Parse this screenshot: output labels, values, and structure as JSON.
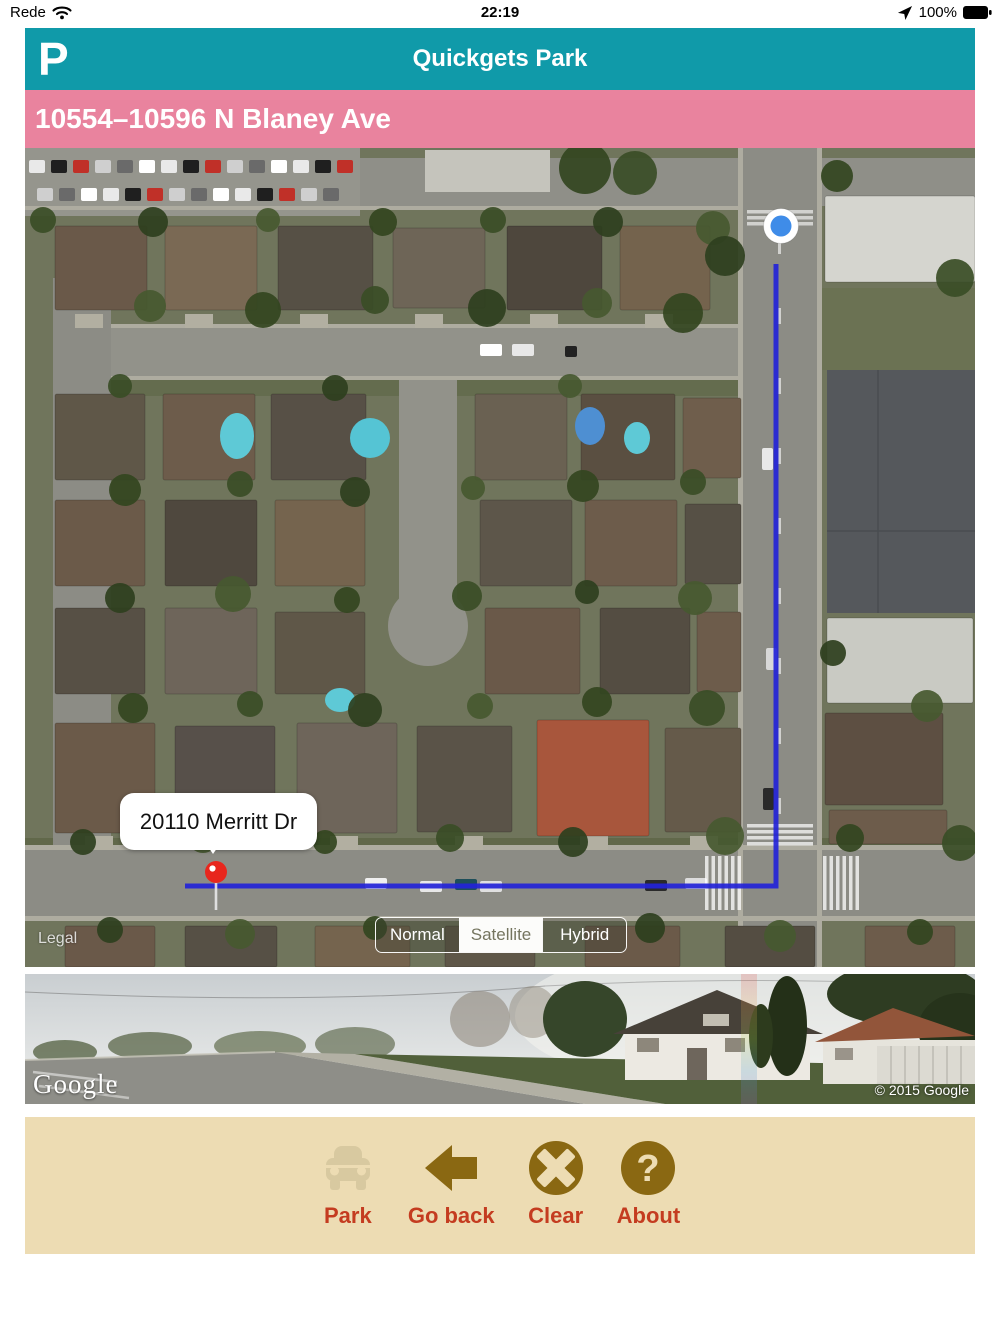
{
  "status_bar": {
    "carrier": "Rede",
    "time": "22:19",
    "battery_percent": "100%"
  },
  "header": {
    "logo": "P",
    "title": "Quickgets Park"
  },
  "address_bar": {
    "text": "10554–10596 N Blaney Ave"
  },
  "map": {
    "callout_text": "20110 Merritt Dr",
    "legal_label": "Legal",
    "type_options": [
      "Normal",
      "Satellite",
      "Hybrid"
    ],
    "selected_type": "Satellite"
  },
  "street_view": {
    "watermark": "Google",
    "copyright": "© 2015 Google"
  },
  "toolbar": {
    "buttons": [
      {
        "label": "Park",
        "icon": "car-icon",
        "enabled": false
      },
      {
        "label": "Go back",
        "icon": "back-arrow-icon",
        "enabled": true
      },
      {
        "label": "Clear",
        "icon": "clear-x-icon",
        "enabled": true
      },
      {
        "label": "About",
        "icon": "question-mark-icon",
        "enabled": true
      }
    ]
  },
  "colors": {
    "header_teal": "#109aa9",
    "address_pink": "#e9839e",
    "toolbar_beige": "#eddcb3",
    "icon_brown": "#8a6812",
    "label_red": "#c43c20",
    "route_blue": "#2323d8"
  }
}
